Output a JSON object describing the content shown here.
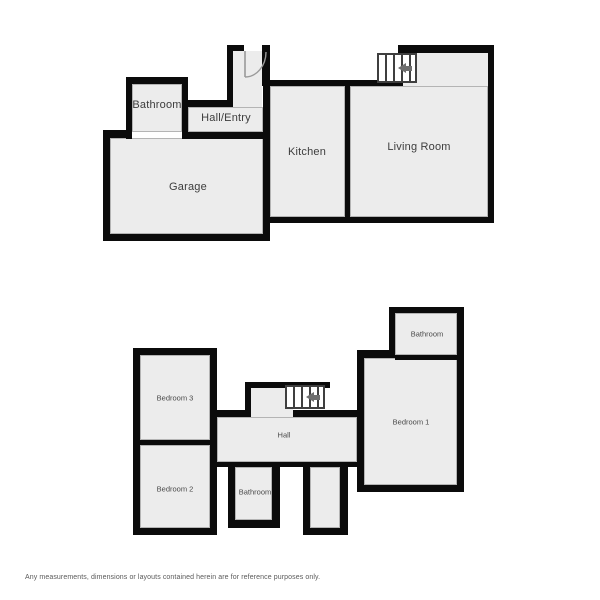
{
  "colors": {
    "wall": "#0b0b0b",
    "room_fill": "#ececec",
    "room_outline": "#b4b4b4",
    "label": "#3d3d3d"
  },
  "floor1": {
    "rooms": {
      "bathroom": "Bathroom",
      "hall_entry": "Hall/Entry",
      "garage": "Garage",
      "kitchen": "Kitchen",
      "living_room": "Living Room"
    },
    "stairs": {
      "arrow_direction": "left"
    }
  },
  "floor2": {
    "rooms": {
      "bathroom_upper": "Bathroom",
      "bedroom1": "Bedroom 1",
      "bedroom3": "Bedroom 3",
      "bedroom2": "Bedroom 2",
      "hall": "Hall",
      "bathroom_lower": "Bathroom"
    },
    "stairs": {
      "arrow_direction": "left"
    }
  },
  "footer": {
    "disclaimer": "Any measurements, dimensions or layouts contained herein are for reference purposes only."
  }
}
